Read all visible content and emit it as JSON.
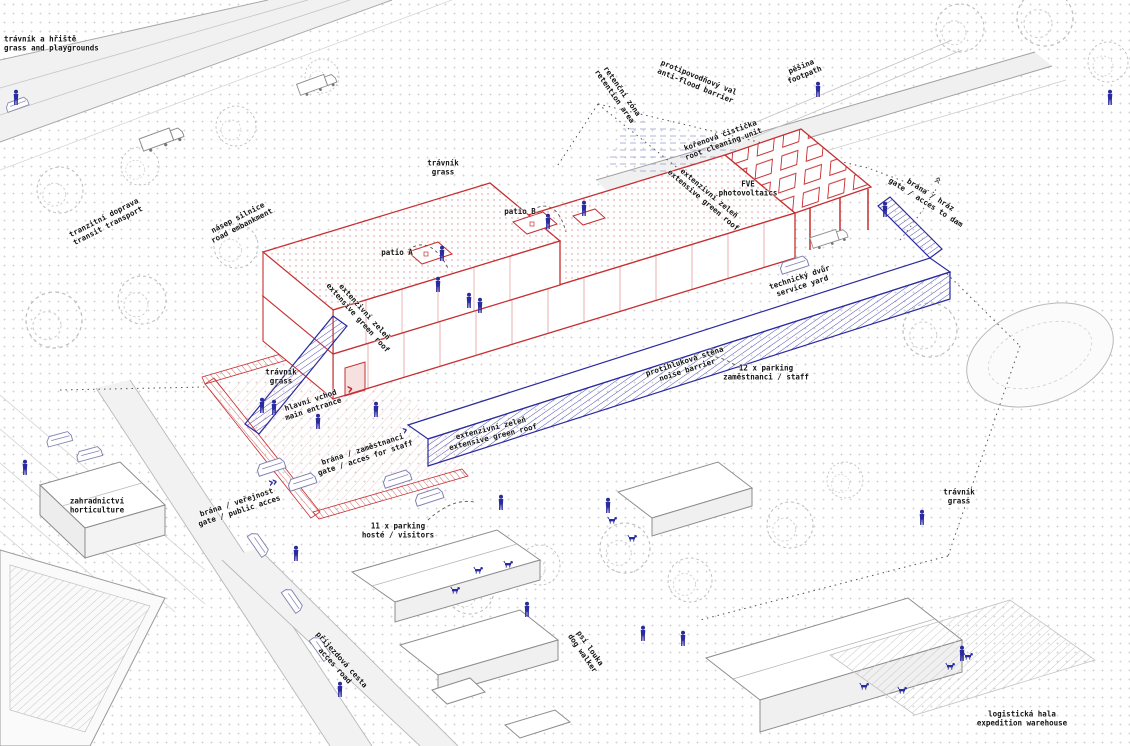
{
  "meta": {
    "drawing_type": "axonometric architectural site plan",
    "languages": "Czech / English"
  },
  "colors": {
    "red": "#c62f31",
    "blue": "#2b2ba0",
    "gray": "#5a5a5a",
    "line_gray": "#9a9a9a",
    "dot_grid": "#d4d4d4",
    "text": "#141414"
  },
  "annotations": [
    {
      "id": "grass-playgrounds",
      "cs": "trávník a hřiště",
      "en": "grass and playgrounds",
      "x": 4,
      "y": 44,
      "rot": 0,
      "align": "left"
    },
    {
      "id": "transit-transport",
      "cs": "tranzitní doprava",
      "en": "transit transport",
      "x": 106,
      "y": 222,
      "rot": -27,
      "align": "center"
    },
    {
      "id": "road-embankment",
      "cs": "násep silnice",
      "en": "road embankment",
      "x": 240,
      "y": 222,
      "rot": -27,
      "align": "center"
    },
    {
      "id": "grass-north",
      "cs": "trávník",
      "en": "grass",
      "x": 443,
      "y": 168,
      "rot": 0,
      "align": "center"
    },
    {
      "id": "patio-a",
      "cs": "patio A",
      "en": "",
      "x": 397,
      "y": 253,
      "rot": 0,
      "align": "center"
    },
    {
      "id": "patio-b",
      "cs": "patio B",
      "en": "",
      "x": 520,
      "y": 212,
      "rot": 0,
      "align": "center"
    },
    {
      "id": "green-roof-upper",
      "cs": "extenzivní zeleň",
      "en": "extensive green roof",
      "x": 361,
      "y": 315,
      "rot": 48,
      "align": "center"
    },
    {
      "id": "retention-area",
      "cs": "retenční zóna",
      "en": "retention area",
      "x": 618,
      "y": 94,
      "rot": 55,
      "align": "center"
    },
    {
      "id": "anti-flood-barrier",
      "cs": "protipovodňový val",
      "en": "anti-flood barrier",
      "x": 697,
      "y": 82,
      "rot": 22,
      "align": "center"
    },
    {
      "id": "footpath",
      "cs": "pěšina",
      "en": "footpath",
      "x": 803,
      "y": 71,
      "rot": -22,
      "align": "center"
    },
    {
      "id": "photovoltaics",
      "cs": "FVE",
      "en": "photovoltaics",
      "x": 748,
      "y": 189,
      "rot": 0,
      "align": "center"
    },
    {
      "id": "green-roof-canopy",
      "cs": "extenzivní zeleň",
      "en": "extensive green roof",
      "x": 706,
      "y": 197,
      "rot": 40,
      "align": "center"
    },
    {
      "id": "root-cleaning-unit",
      "cs": "kořenová čistička",
      "en": "root cleaning unit",
      "x": 722,
      "y": 140,
      "rot": -20,
      "align": "center"
    },
    {
      "id": "gate-to-dam",
      "cs": "brána / hráz",
      "en": "gate / acces to dam",
      "x": 928,
      "y": 199,
      "rot": 32,
      "align": "center"
    },
    {
      "id": "service-yard",
      "cs": "technický dvůr",
      "en": "service yard",
      "x": 801,
      "y": 282,
      "rot": -18,
      "align": "center"
    },
    {
      "id": "noise-barrier",
      "cs": "protihluková stěna",
      "en": "noise barrier",
      "x": 686,
      "y": 366,
      "rot": -18,
      "align": "center"
    },
    {
      "id": "parking-staff",
      "cs": "12 x parking",
      "en": "zaměstnanci / staff",
      "x": 766,
      "y": 373,
      "rot": 0,
      "align": "center"
    },
    {
      "id": "grass-west",
      "cs": "trávník",
      "en": "grass",
      "x": 281,
      "y": 377,
      "rot": 0,
      "align": "center"
    },
    {
      "id": "main-entrance",
      "cs": "hlavní vchod",
      "en": "main entrance",
      "x": 312,
      "y": 405,
      "rot": -18,
      "align": "center"
    },
    {
      "id": "gate-staff",
      "cs": "brána / zaměstnanci",
      "en": "gate / acces for staff",
      "x": 364,
      "y": 454,
      "rot": -18,
      "align": "center"
    },
    {
      "id": "gate-public",
      "cs": "brána / veřejnost",
      "en": "gate / public acces",
      "x": 238,
      "y": 507,
      "rot": -18,
      "align": "center"
    },
    {
      "id": "parking-visitors",
      "cs": "11 x parking",
      "en": "hosté / visitors",
      "x": 398,
      "y": 531,
      "rot": 0,
      "align": "center"
    },
    {
      "id": "green-roof-front",
      "cs": "extenzivní zeleň",
      "en": "extensive green roof",
      "x": 492,
      "y": 433,
      "rot": -14,
      "align": "center"
    },
    {
      "id": "horticulture",
      "cs": "zahradnictví",
      "en": "horticulture",
      "x": 97,
      "y": 506,
      "rot": 0,
      "align": "center"
    },
    {
      "id": "access-road",
      "cs": "příjezdová cesta",
      "en": "acces road",
      "x": 338,
      "y": 663,
      "rot": 48,
      "align": "center"
    },
    {
      "id": "dog-meadow",
      "cs": "psí louka",
      "en": "dog walker",
      "x": 586,
      "y": 651,
      "rot": 55,
      "align": "center"
    },
    {
      "id": "grass-east",
      "cs": "trávník",
      "en": "grass",
      "x": 959,
      "y": 497,
      "rot": 0,
      "align": "center"
    },
    {
      "id": "expedition-warehouse",
      "cs": "logistická hala",
      "en": "expedition warehouse",
      "x": 1022,
      "y": 719,
      "rot": 0,
      "align": "center"
    }
  ],
  "arrows": [
    {
      "id": "entrance-arrow",
      "glyph": "›",
      "x": 349,
      "y": 391,
      "rot": -12,
      "color": "red",
      "size": 17
    },
    {
      "id": "public-gate-arrows",
      "glyph": "››",
      "x": 272,
      "y": 484,
      "rot": -14,
      "color": "blue",
      "size": 14
    },
    {
      "id": "staff-gate-arrow",
      "glyph": "›",
      "x": 404,
      "y": 432,
      "rot": -20,
      "color": "blue",
      "size": 14
    },
    {
      "id": "dam-trail-arrows",
      "glyph": "››",
      "x": 937,
      "y": 182,
      "rot": -65,
      "color": "gray",
      "size": 12
    }
  ]
}
